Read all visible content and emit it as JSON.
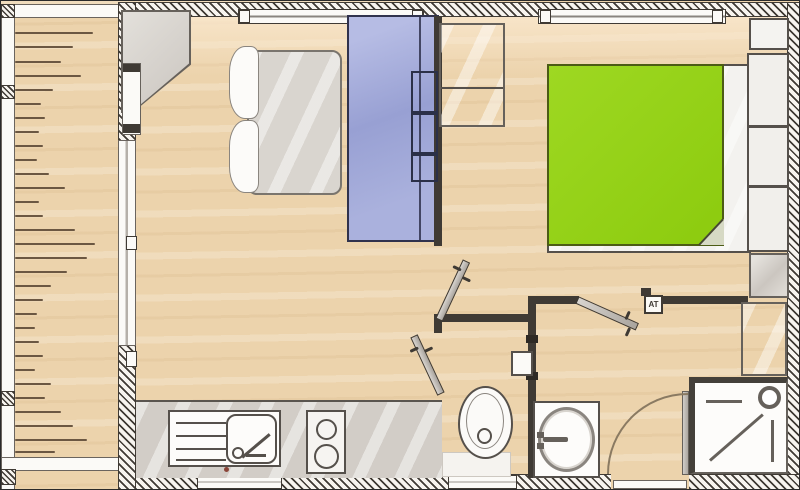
{
  "title": "mobile-home-floor-plan",
  "at_label": "AT",
  "colors": {
    "wood": "#ecd3ac",
    "wood_light": "#f8e8cd",
    "wall_dark": "#3f3a34",
    "hatch_bg": "#f7f4ef",
    "furniture_border": "#66615b",
    "fixture_border": "#55504b",
    "white": "#fbfaf7",
    "counter": "#d2cdc7",
    "bed_blue_light": "#b6bce4",
    "bed_blue": "#98a0d3",
    "blue_border": "#30324d",
    "duvet_green": "#93d314",
    "green_border": "#4c5c15",
    "fold": "#d6d9c4",
    "arc": "#8a7a62",
    "plank": "#6b5742",
    "duvet_gray": "#d9d5cf"
  },
  "deck": {
    "planks": [
      {
        "y": 31,
        "len": 78
      },
      {
        "y": 45,
        "len": 58
      },
      {
        "y": 60,
        "len": 46
      },
      {
        "y": 74,
        "len": 66
      },
      {
        "y": 88,
        "len": 38
      },
      {
        "y": 102,
        "len": 26
      },
      {
        "y": 116,
        "len": 30
      },
      {
        "y": 130,
        "len": 24
      },
      {
        "y": 144,
        "len": 28
      },
      {
        "y": 158,
        "len": 22
      },
      {
        "y": 172,
        "len": 34
      },
      {
        "y": 186,
        "len": 50
      },
      {
        "y": 200,
        "len": 24
      },
      {
        "y": 214,
        "len": 28
      },
      {
        "y": 228,
        "len": 60
      },
      {
        "y": 242,
        "len": 80
      },
      {
        "y": 256,
        "len": 72
      },
      {
        "y": 270,
        "len": 52
      },
      {
        "y": 284,
        "len": 36
      },
      {
        "y": 298,
        "len": 28
      },
      {
        "y": 312,
        "len": 22
      },
      {
        "y": 326,
        "len": 20
      },
      {
        "y": 340,
        "len": 24
      },
      {
        "y": 354,
        "len": 28
      },
      {
        "y": 368,
        "len": 20
      },
      {
        "y": 382,
        "len": 36
      },
      {
        "y": 396,
        "len": 30
      },
      {
        "y": 410,
        "len": 46
      },
      {
        "y": 424,
        "len": 58
      },
      {
        "y": 438,
        "len": 72
      },
      {
        "y": 450,
        "len": 40
      }
    ]
  }
}
